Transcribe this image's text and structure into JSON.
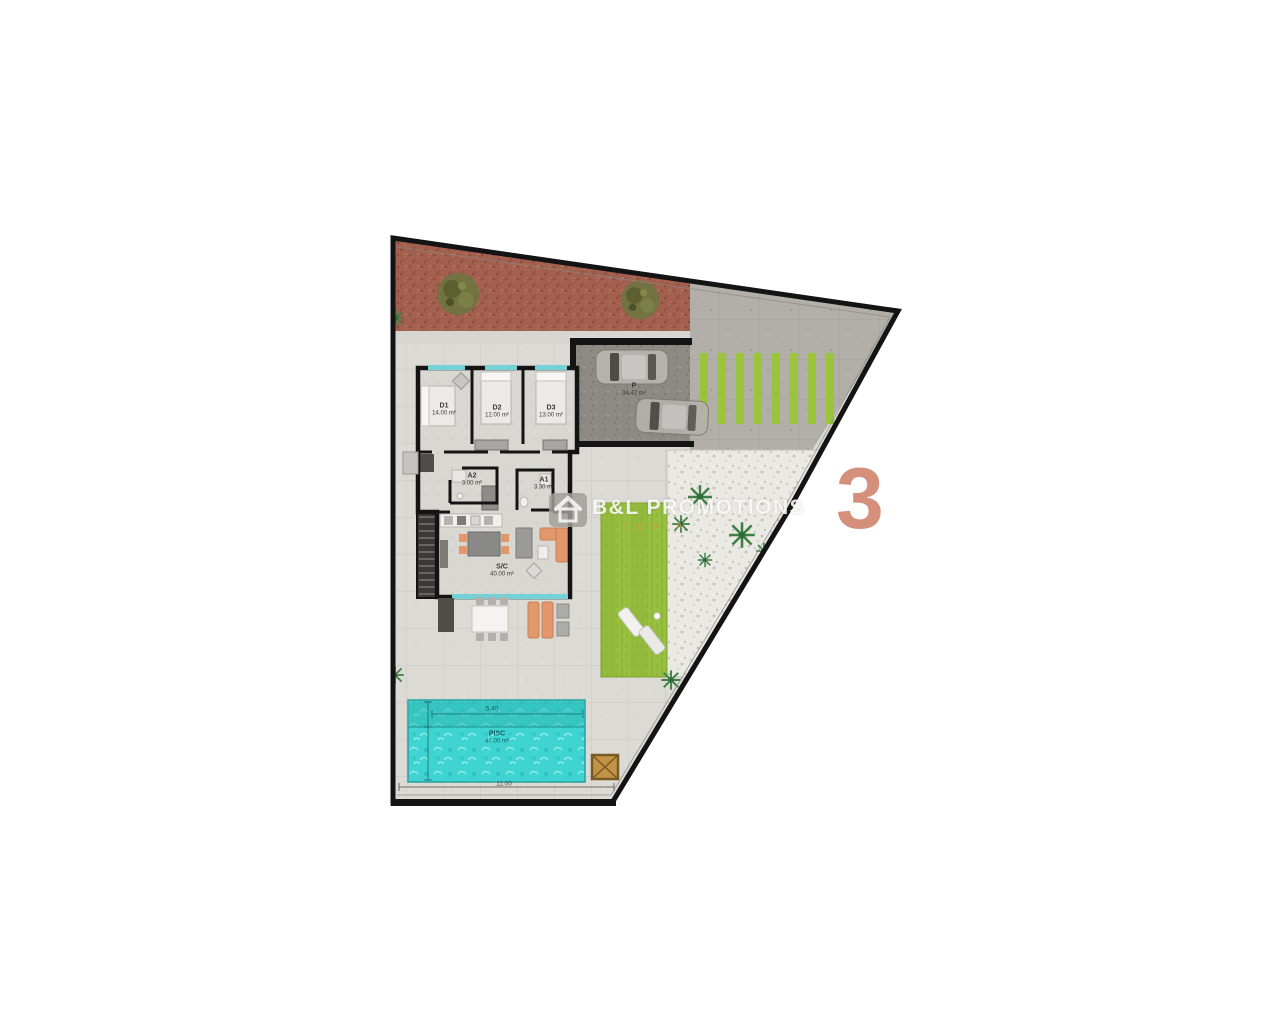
{
  "plan": {
    "plot_number": "3",
    "watermark": {
      "brand": "B&L PROMOTIONS",
      "tagline": "COSTA",
      "icon": "house-logo-icon"
    },
    "rooms": [
      {
        "id": "bedroom-1",
        "code": "D1",
        "area": "14.00 m²"
      },
      {
        "id": "bedroom-2",
        "code": "D2",
        "area": "12.00 m²"
      },
      {
        "id": "bedroom-3",
        "code": "D3",
        "area": "13.00 m²"
      },
      {
        "id": "bathroom-2",
        "code": "A2",
        "area": "3.00 m²"
      },
      {
        "id": "bathroom-1",
        "code": "A1",
        "area": "3.30 m²"
      },
      {
        "id": "living-kitchen",
        "code": "S/C",
        "area": "40.00 m²"
      },
      {
        "id": "parking",
        "code": "P",
        "area": "34.42 m²"
      },
      {
        "id": "pool",
        "code": "PISC",
        "area": "47.00 m²"
      }
    ],
    "dimensions": {
      "pool_width": "5.40",
      "plot_frontage": "11.00"
    },
    "colors": {
      "accent_number": "#d4907a",
      "watermark_orange": "#e09a56",
      "pool_water": "#3fd3d1",
      "lawn_green": "#97bf40",
      "stripe_green": "#9cc33c",
      "gravel_red": "#a4604f"
    }
  }
}
